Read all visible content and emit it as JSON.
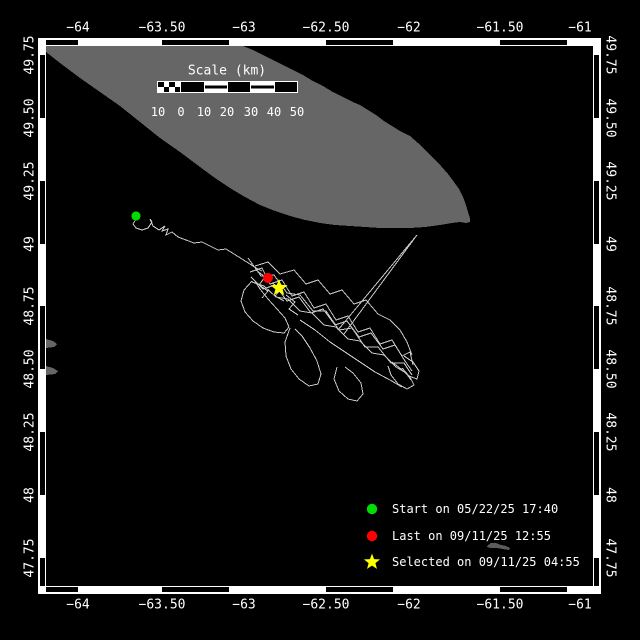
{
  "colors": {
    "background": "#000000",
    "frame": "#ffffff",
    "land": "#666666",
    "land_small": "#5c5c5c",
    "track": "#c8c8c8",
    "start": "#00dd00",
    "last": "#ff0000",
    "selected": "#ffff00"
  },
  "frame": {
    "top_labels": [
      {
        "t": "−64",
        "x": 78
      },
      {
        "t": "−63.50",
        "x": 162
      },
      {
        "t": "−63",
        "x": 244
      },
      {
        "t": "−62.50",
        "x": 326
      },
      {
        "t": "−62",
        "x": 409
      },
      {
        "t": "−61.50",
        "x": 500
      },
      {
        "t": "−61",
        "x": 580
      }
    ],
    "bottom_labels": [
      {
        "t": "−64",
        "x": 78
      },
      {
        "t": "−63.50",
        "x": 162
      },
      {
        "t": "−63",
        "x": 244
      },
      {
        "t": "−62.50",
        "x": 326
      },
      {
        "t": "−62",
        "x": 409
      },
      {
        "t": "−61.50",
        "x": 500
      },
      {
        "t": "−61",
        "x": 580
      }
    ],
    "left_labels": [
      {
        "t": "49.75",
        "y": 55
      },
      {
        "t": "49.50",
        "y": 118
      },
      {
        "t": "49.25",
        "y": 181
      },
      {
        "t": "49",
        "y": 244
      },
      {
        "t": "48.75",
        "y": 306
      },
      {
        "t": "48.50",
        "y": 369
      },
      {
        "t": "48.25",
        "y": 432
      },
      {
        "t": "48",
        "y": 495
      },
      {
        "t": "47.75",
        "y": 558
      }
    ],
    "right_labels": [
      {
        "t": "49.75",
        "y": 55
      },
      {
        "t": "49.50",
        "y": 118
      },
      {
        "t": "49.25",
        "y": 181
      },
      {
        "t": "49",
        "y": 244
      },
      {
        "t": "48.75",
        "y": 306
      },
      {
        "t": "48.50",
        "y": 369
      },
      {
        "t": "48.25",
        "y": 432
      },
      {
        "t": "48",
        "y": 495
      },
      {
        "t": "47.75",
        "y": 558
      }
    ],
    "h_black_bars": [
      [
        46,
        78
      ],
      [
        162,
        229
      ],
      [
        326,
        393
      ],
      [
        500,
        567
      ]
    ],
    "v_black_bars": [
      [
        55,
        118
      ],
      [
        181,
        244
      ],
      [
        306,
        369
      ],
      [
        432,
        495
      ],
      [
        558,
        586
      ]
    ]
  },
  "scalebar": {
    "title": "Scale (km)",
    "title_pos": {
      "x": 227,
      "y": 71
    },
    "bar": {
      "x": 157,
      "y": 81,
      "w": 141,
      "h": 12
    },
    "segments": [
      "checker",
      "black",
      "striped",
      "black",
      "striped",
      "black"
    ],
    "tick_labels": [
      "10",
      "0",
      "10",
      "20",
      "30",
      "40",
      "50"
    ],
    "tick_x": [
      158,
      181,
      204,
      227,
      251,
      274,
      297
    ],
    "labels_y": 112
  },
  "legend": {
    "marker_x": 372,
    "text_x": 392,
    "items": [
      {
        "marker": "circle",
        "color": "#00dd00",
        "label": "Start on 05/22/25 17:40",
        "y": 509
      },
      {
        "marker": "circle",
        "color": "#ff0000",
        "label": "Last on 09/11/25 12:55",
        "y": 536
      },
      {
        "marker": "star",
        "color": "#ffff00",
        "label": "Selected on 09/11/25 04:55",
        "y": 562
      }
    ]
  },
  "map": {
    "plot": {
      "x": 46,
      "y": 46,
      "w": 547,
      "h": 540
    },
    "islands": [
      {
        "name": "island-anticosti",
        "color": "#666666",
        "points": [
          [
            46,
            46
          ],
          [
            243,
            46
          ],
          [
            253,
            50
          ],
          [
            263,
            55
          ],
          [
            273,
            60
          ],
          [
            283,
            65
          ],
          [
            293,
            70
          ],
          [
            303,
            75
          ],
          [
            313,
            81
          ],
          [
            323,
            86
          ],
          [
            333,
            92
          ],
          [
            343,
            97
          ],
          [
            353,
            102
          ],
          [
            360,
            105
          ],
          [
            368,
            110
          ],
          [
            376,
            115
          ],
          [
            384,
            121
          ],
          [
            392,
            126
          ],
          [
            400,
            131
          ],
          [
            410,
            136
          ],
          [
            418,
            143
          ],
          [
            426,
            151
          ],
          [
            434,
            159
          ],
          [
            441,
            166
          ],
          [
            448,
            174
          ],
          [
            454,
            182
          ],
          [
            459,
            189
          ],
          [
            463,
            197
          ],
          [
            466,
            205
          ],
          [
            468,
            212
          ],
          [
            470,
            218
          ],
          [
            470,
            222
          ],
          [
            466,
            223
          ],
          [
            460,
            222
          ],
          [
            452,
            223
          ],
          [
            440,
            225
          ],
          [
            425,
            227
          ],
          [
            410,
            228
          ],
          [
            395,
            228
          ],
          [
            380,
            228
          ],
          [
            365,
            227
          ],
          [
            350,
            226
          ],
          [
            335,
            225
          ],
          [
            320,
            223
          ],
          [
            305,
            220
          ],
          [
            290,
            216
          ],
          [
            275,
            211
          ],
          [
            260,
            205
          ],
          [
            245,
            197
          ],
          [
            230,
            188
          ],
          [
            215,
            178
          ],
          [
            200,
            167
          ],
          [
            180,
            152
          ],
          [
            160,
            138
          ],
          [
            140,
            122
          ],
          [
            120,
            106
          ],
          [
            100,
            92
          ],
          [
            80,
            78
          ],
          [
            60,
            63
          ],
          [
            46,
            52
          ]
        ]
      },
      {
        "name": "island-small",
        "color": "#5c5c5c",
        "points": [
          [
            487,
            546
          ],
          [
            491,
            543
          ],
          [
            496,
            543
          ],
          [
            501,
            545
          ],
          [
            506,
            546
          ],
          [
            510,
            548
          ],
          [
            509,
            550
          ],
          [
            503,
            549
          ],
          [
            497,
            548
          ],
          [
            491,
            548
          ],
          [
            487,
            547
          ]
        ]
      },
      {
        "name": "coast-nub-1",
        "color": "#666666",
        "points": [
          [
            46,
            339
          ],
          [
            53,
            341
          ],
          [
            57,
            344
          ],
          [
            54,
            347
          ],
          [
            46,
            348
          ]
        ]
      },
      {
        "name": "coast-nub-2",
        "color": "#666666",
        "points": [
          [
            46,
            366
          ],
          [
            53,
            368
          ],
          [
            58,
            371
          ],
          [
            55,
            374
          ],
          [
            46,
            375
          ]
        ]
      }
    ],
    "track": {
      "color": "#c8c8c8",
      "polylines": [
        [
          [
            136,
            219
          ],
          [
            133,
            224
          ],
          [
            136,
            228
          ],
          [
            142,
            230
          ],
          [
            148,
            228
          ],
          [
            152,
            222
          ],
          [
            150,
            219
          ],
          [
            153,
            226
          ],
          [
            159,
            230
          ],
          [
            165,
            226
          ],
          [
            162,
            231
          ],
          [
            168,
            229
          ],
          [
            166,
            235
          ],
          [
            172,
            232
          ],
          [
            178,
            237
          ],
          [
            186,
            240
          ],
          [
            194,
            243
          ],
          [
            202,
            242
          ],
          [
            210,
            246
          ],
          [
            218,
            250
          ],
          [
            226,
            249
          ],
          [
            234,
            254
          ],
          [
            242,
            259
          ],
          [
            250,
            264
          ],
          [
            256,
            268
          ],
          [
            262,
            271
          ]
        ],
        [
          [
            338,
            330
          ],
          [
            417,
            235
          ],
          [
            344,
            334
          ]
        ],
        [
          [
            248,
            258
          ],
          [
            261,
            276
          ],
          [
            274,
            275
          ],
          [
            287,
            293
          ],
          [
            300,
            295
          ],
          [
            313,
            311
          ],
          [
            326,
            311
          ],
          [
            339,
            330
          ],
          [
            352,
            328
          ],
          [
            365,
            347
          ],
          [
            378,
            347
          ],
          [
            391,
            363
          ],
          [
            404,
            363
          ],
          [
            412,
            375
          ]
        ],
        [
          [
            252,
            282
          ],
          [
            264,
            286
          ],
          [
            276,
            297
          ],
          [
            288,
            299
          ],
          [
            300,
            311
          ],
          [
            312,
            313
          ],
          [
            324,
            325
          ],
          [
            336,
            327
          ],
          [
            348,
            339
          ],
          [
            360,
            341
          ],
          [
            372,
            353
          ],
          [
            384,
            355
          ],
          [
            396,
            367
          ],
          [
            406,
            373
          ],
          [
            411,
            380
          ]
        ],
        [
          [
            250,
            272
          ],
          [
            262,
            268
          ],
          [
            270,
            284
          ],
          [
            282,
            280
          ],
          [
            292,
            296
          ],
          [
            304,
            292
          ],
          [
            314,
            308
          ],
          [
            326,
            304
          ],
          [
            336,
            320
          ],
          [
            348,
            316
          ],
          [
            358,
            332
          ],
          [
            370,
            328
          ],
          [
            380,
            344
          ],
          [
            392,
            340
          ],
          [
            402,
            356
          ],
          [
            410,
            352
          ],
          [
            413,
            365
          ]
        ],
        [
          [
            251,
            277
          ],
          [
            263,
            289
          ],
          [
            275,
            285
          ],
          [
            287,
            301
          ],
          [
            299,
            297
          ],
          [
            311,
            313
          ],
          [
            323,
            309
          ],
          [
            335,
            325
          ],
          [
            347,
            321
          ],
          [
            359,
            337
          ],
          [
            371,
            333
          ],
          [
            383,
            349
          ],
          [
            395,
            345
          ],
          [
            405,
            361
          ],
          [
            412,
            371
          ]
        ],
        [
          [
            255,
            266
          ],
          [
            268,
            262
          ],
          [
            280,
            274
          ],
          [
            294,
            270
          ],
          [
            306,
            284
          ],
          [
            318,
            280
          ],
          [
            330,
            294
          ],
          [
            342,
            290
          ],
          [
            354,
            304
          ],
          [
            366,
            300
          ],
          [
            378,
            314
          ],
          [
            390,
            320
          ],
          [
            400,
            330
          ],
          [
            407,
            342
          ],
          [
            412,
            355
          ]
        ],
        [
          [
            300,
            320
          ],
          [
            315,
            330
          ],
          [
            330,
            342
          ],
          [
            345,
            352
          ],
          [
            360,
            362
          ],
          [
            375,
            372
          ],
          [
            390,
            380
          ],
          [
            402,
            387
          ]
        ],
        [
          [
            252,
            281
          ],
          [
            244,
            290
          ],
          [
            241,
            301
          ],
          [
            245,
            312
          ],
          [
            253,
            321
          ],
          [
            263,
            328
          ],
          [
            274,
            332
          ],
          [
            284,
            333
          ],
          [
            289,
            327
          ],
          [
            285,
            318
          ],
          [
            277,
            309
          ],
          [
            268,
            299
          ],
          [
            260,
            289
          ],
          [
            255,
            281
          ]
        ],
        [
          [
            290,
            328
          ],
          [
            285,
            342
          ],
          [
            286,
            356
          ],
          [
            291,
            369
          ],
          [
            299,
            379
          ],
          [
            309,
            386
          ],
          [
            318,
            384
          ],
          [
            321,
            374
          ],
          [
            317,
            361
          ],
          [
            310,
            348
          ],
          [
            302,
            336
          ],
          [
            295,
            329
          ]
        ],
        [
          [
            337,
            367
          ],
          [
            334,
            379
          ],
          [
            339,
            391
          ],
          [
            348,
            399
          ],
          [
            357,
            401
          ],
          [
            363,
            394
          ],
          [
            361,
            383
          ],
          [
            353,
            373
          ],
          [
            345,
            367
          ]
        ],
        [
          [
            392,
            362
          ],
          [
            401,
            369
          ],
          [
            410,
            377
          ],
          [
            414,
            385
          ],
          [
            407,
            389
          ],
          [
            398,
            384
          ],
          [
            391,
            375
          ],
          [
            388,
            366
          ]
        ],
        [
          [
            404,
            356
          ],
          [
            413,
            362
          ],
          [
            419,
            371
          ],
          [
            417,
            379
          ],
          [
            409,
            376
          ],
          [
            402,
            368
          ]
        ],
        [
          [
            256,
            270
          ],
          [
            265,
            277
          ],
          [
            259,
            285
          ],
          [
            268,
            291
          ],
          [
            262,
            298
          ]
        ],
        [
          [
            272,
            283
          ],
          [
            281,
            289
          ],
          [
            275,
            296
          ],
          [
            284,
            301
          ]
        ],
        [
          [
            286,
            295
          ],
          [
            295,
            302
          ],
          [
            289,
            309
          ],
          [
            298,
            315
          ]
        ]
      ]
    },
    "markers": [
      {
        "type": "circle",
        "name": "start-marker",
        "color": "#00dd00",
        "x": 136,
        "y": 216,
        "r": 4.5
      },
      {
        "type": "circle",
        "name": "last-marker",
        "color": "#ff0000",
        "x": 268,
        "y": 278,
        "r": 5
      },
      {
        "type": "star",
        "name": "selected-marker",
        "color": "#ffff00",
        "x": 279,
        "y": 288,
        "r": 9
      }
    ]
  }
}
